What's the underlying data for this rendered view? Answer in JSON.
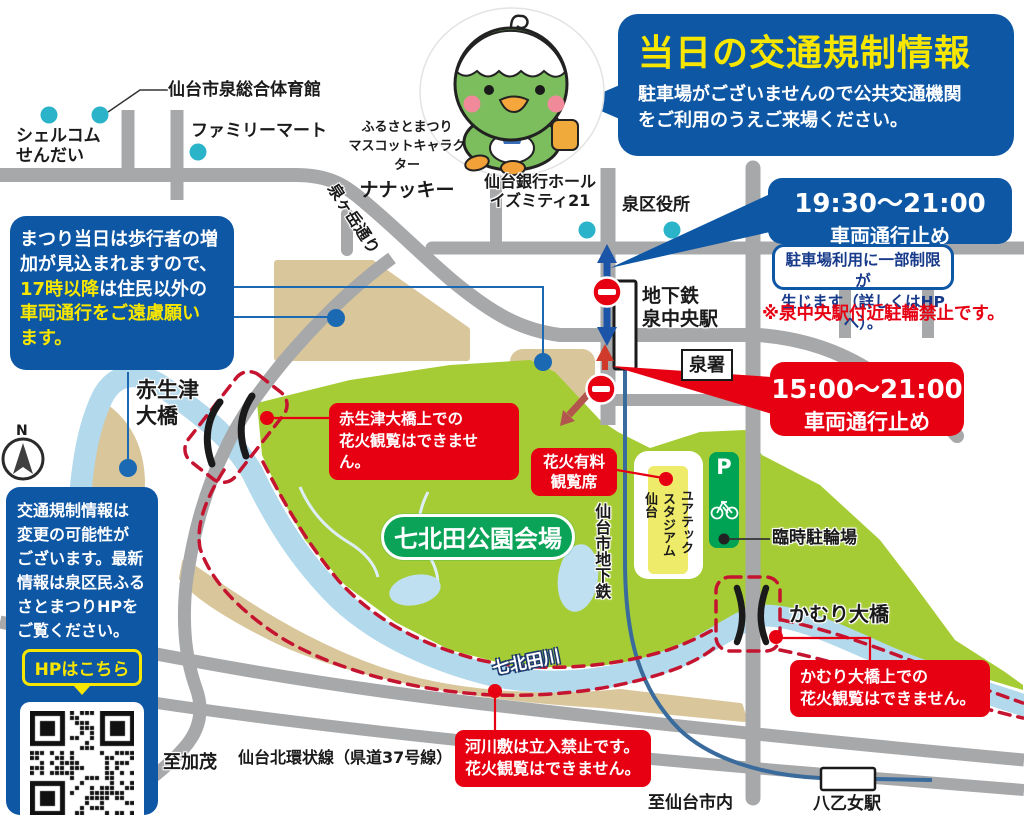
{
  "header": {
    "title": "当日の交通規制情報",
    "subtitle": "駐車場がございませんので公共交通機関\nをご利用のうえご来場ください。"
  },
  "mascot": {
    "caption1": "ふるさとまつり",
    "caption2": "マスコットキャラクター",
    "name": "ナナッキー"
  },
  "pedestrian_notice": {
    "w1": "まつり当日は歩行者の増",
    "w2": "加が見込まれますので、",
    "y3": "17時以降",
    "w3": "は住民以外の",
    "y4": "車両通行をご遠慮願い",
    "y5": "ます。"
  },
  "update_notice": {
    "text": "交通規制情報は\n変更の可能性が\nございます。最新\n情報は泉区民ふる\nさとまつりHPを\nご覧ください。",
    "button": "HPはこちら"
  },
  "closures": {
    "evening": {
      "time": "19:30〜21:00",
      "label": "車両通行止め"
    },
    "day": {
      "time": "15:00〜21:00",
      "label": "車両通行止め"
    },
    "parking_note": "駐車場利用に一部制限が\n生じます（詳しくはHPへ）。",
    "bicycle_note": "※泉中央駅付近駐輪禁止です。"
  },
  "warnings": {
    "akaoizu": {
      "l1": "赤生津大橋上での",
      "l2": "花火観覧はできません。"
    },
    "kamuri": {
      "l1": "かむり大橋上での",
      "l2": "花火観覧はできません。"
    },
    "riverbed": {
      "l1": "河川敷は立入禁止です。",
      "l2": "花火観覧はできません。"
    },
    "paid_seats": {
      "l1": "花火有料",
      "l2": "観覧席"
    }
  },
  "map_labels": {
    "gymnasium": "仙台市泉総合体育館",
    "shellcom1": "シェルコム",
    "shellcom2": "せんだい",
    "familymart": "ファミリーマート",
    "izumigatake_st": "泉ヶ岳通り",
    "bankhall1": "仙台銀行ホール",
    "bankhall2": "イズミティ21",
    "ward_office": "泉区役所",
    "station1": "地下鉄",
    "station2": "泉中央駅",
    "police": "泉署",
    "akaoizu1": "赤生津",
    "akaoizu2": "大橋",
    "park_venue": "七北田公園会場",
    "stadium_col1": "ユアテック",
    "stadium_col2": "スタジアム",
    "stadium_col3": "仙台",
    "subway_line": "仙台市地下鉄",
    "parking_mark": "P",
    "bike_parking": "臨時駐輪場",
    "kamuri_bridge": "かむり大橋",
    "river": "七北田川",
    "to_kamo": "至加茂",
    "beltline": "仙台北環状線（県道37号線）",
    "to_sendai": "至仙台市内",
    "yaotome_sta": "八乙女駅",
    "compass_n": "N"
  },
  "colors": {
    "accent_blue": "#0e57a5",
    "accent_red": "#e60012",
    "accent_yellow": "#f7e600",
    "park_green": "#a6cc35",
    "venue_green": "#0aa357",
    "road_gray": "#a7a8aa",
    "river_blue": "#b2d9ec",
    "teal_dot": "#2ab3c9",
    "leader_blue": "#1b69b3"
  }
}
